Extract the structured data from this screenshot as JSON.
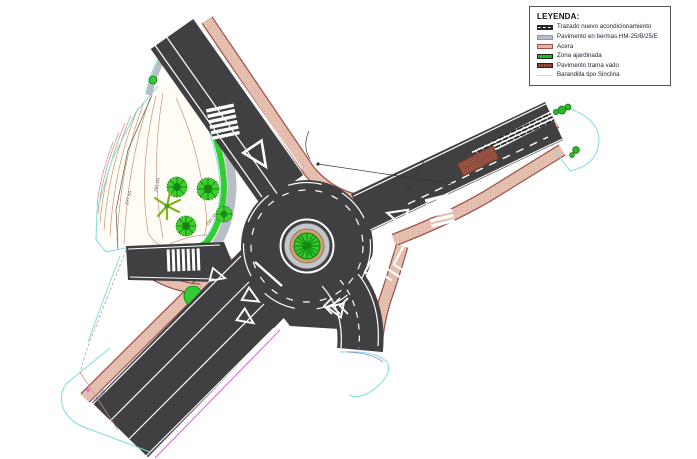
{
  "legend": {
    "title": "LEYENDA:",
    "items": [
      {
        "swatch": "road-swatch",
        "label": "Trazado nuevo acondicionamiento"
      },
      {
        "swatch": "berm-swatch",
        "label": "Pavimento en bermas HM-25/B/25/E"
      },
      {
        "swatch": "sidewalk-swatch",
        "label": "Acera"
      },
      {
        "swatch": "garden-swatch",
        "label": "Zona ajardinada"
      },
      {
        "swatch": "vado-swatch",
        "label": "Pavimento trama vado"
      },
      {
        "swatch": "railing-swatch",
        "label": "Barandilla tipo Sinclina"
      }
    ]
  },
  "plan": {
    "elevations": {
      "e1": "281.00",
      "e2": "277.50",
      "e3": "280.36",
      "e4": "284.28"
    },
    "colors": {
      "asphalt": "#404043",
      "acera": "#ecc9ba",
      "acera_border": "#9c5248",
      "berm": "#b9bdc6",
      "garden": "#33cc33",
      "vado": "#a05a48",
      "railing": "#a8e8e4",
      "contour": "#c9927b",
      "boundary_cyan": "#7fdede",
      "boundary_magenta": "#dd66dd",
      "marking": "#ffffff"
    }
  }
}
